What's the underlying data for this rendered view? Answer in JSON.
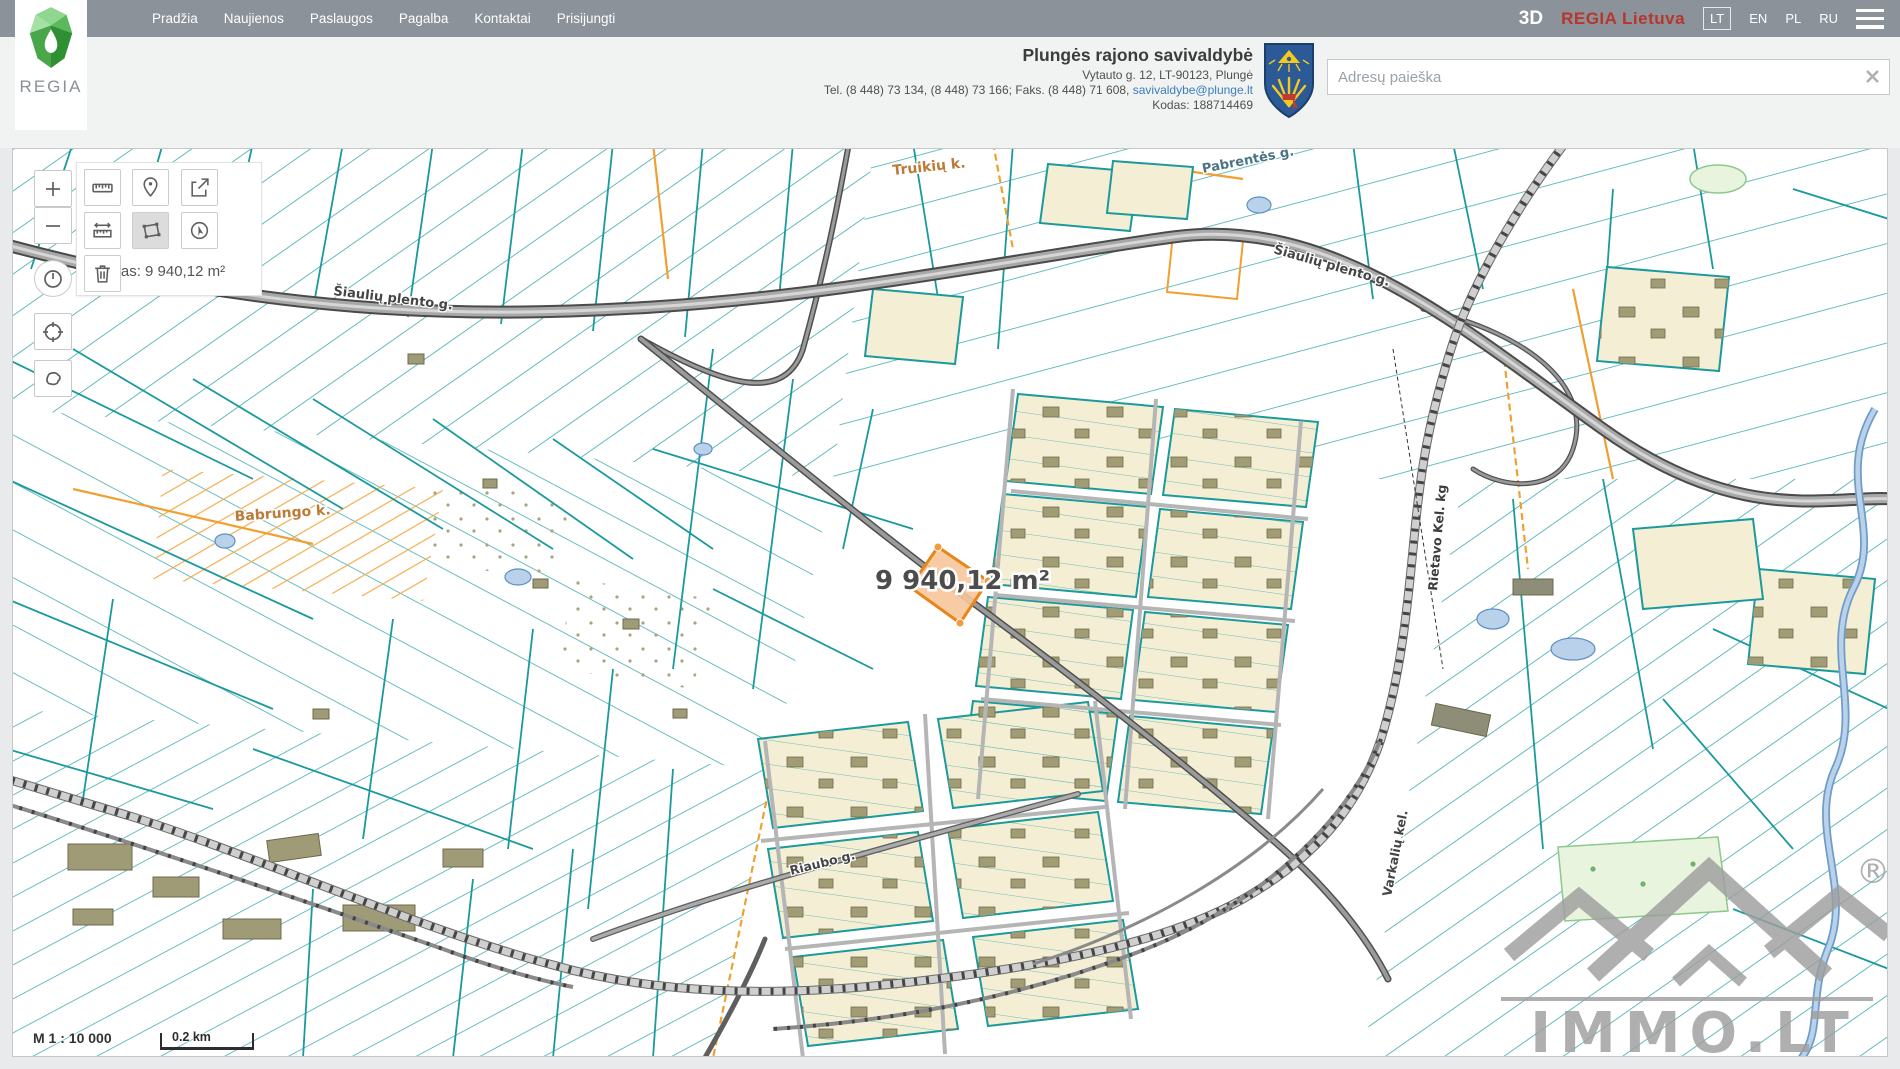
{
  "topnav": {
    "menu": [
      "Pradžia",
      "Naujienos",
      "Paslaugos",
      "Pagalba",
      "Kontaktai",
      "Prisijungti"
    ],
    "view_3d_label": "3D",
    "brand": "REGIA Lietuva",
    "languages": [
      "LT",
      "EN",
      "PL",
      "RU"
    ],
    "active_language": "LT",
    "icons": {
      "menu": "hamburger-icon"
    }
  },
  "header": {
    "logo_text": "REGIA",
    "municipality": {
      "name": "Plungės rajono savivaldybė",
      "address": "Vytauto g. 12, LT-90123, Plungė",
      "phones": "Tel. (8 448) 73 134, (8 448) 73 166; Faks. (8 448) 71 608,",
      "email": "savivaldybe@plunge.lt",
      "code": "Kodas: 188714469"
    },
    "search": {
      "placeholder": "Adresų paieška",
      "icons": {
        "clear": "close-icon"
      }
    }
  },
  "toolbar": {
    "area_readout": "Plotas: 9 940,12 m²",
    "active_tool": "area-measure",
    "tool_icons": [
      "ruler-icon",
      "marker-icon",
      "export-icon",
      "target-icon",
      "distance-measure-icon",
      "area-measure-icon",
      "compass-cursor-icon",
      "trash-icon"
    ],
    "side_icons": [
      "plus-icon",
      "minus-icon",
      "clock-icon",
      "crosshair-icon",
      "lasso-icon"
    ]
  },
  "map": {
    "measured_area_label": "9 940,12 m²",
    "labels": {
      "village_top": "Truikių k.",
      "village_left": "Babrungo k.",
      "road_nw": "Šiaulių plento g.",
      "road_se": "Šiaulių plento g.",
      "street_ne": "Pabrentės g.",
      "railway": "Rietavo Kel. kg",
      "street_riaubo": "Riaubo g.",
      "road_varkaliu": "Varkalių kel."
    },
    "scale": {
      "ratio_text": "M 1 : 10 000",
      "bar_text": "0.2 km"
    },
    "watermark": {
      "text": "IMMO.LT",
      "reg": "®"
    }
  },
  "colors": {
    "nav_bg": "#8b929a",
    "brand_red": "#b8352c",
    "parcel_teal": "#1a9a9c",
    "boundary_orange": "#f0a030",
    "highlight_orange": "#e8861a",
    "highlight_fill": "#f6c79b",
    "block_fill": "#f4efd4",
    "building_fill": "#a19c74",
    "road_gray": "#a8a8a8",
    "water": "#b9d2ea"
  }
}
